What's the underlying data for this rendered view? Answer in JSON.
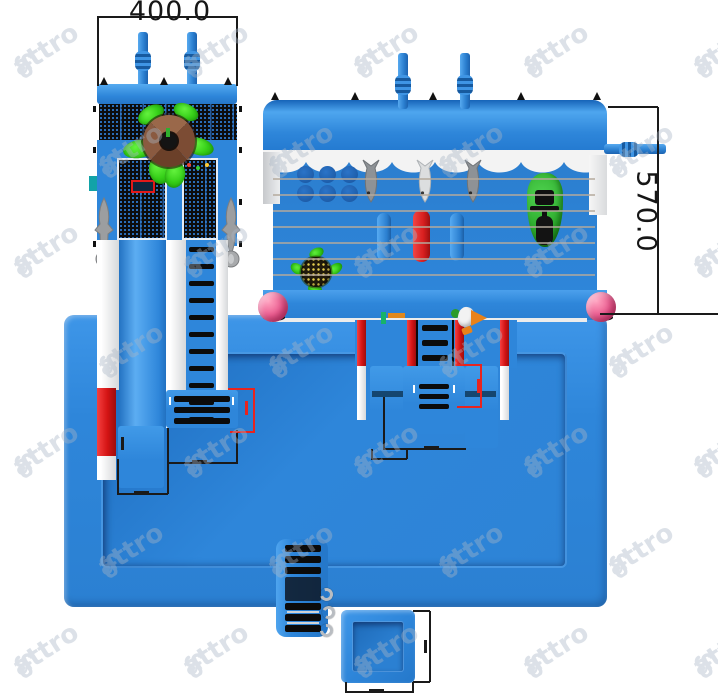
{
  "drawing": {
    "width_dimension": "400.0",
    "height_dimension": "570.0"
  },
  "watermark": {
    "text": "attro"
  },
  "icons": {
    "tree_top": "tree-top-view",
    "shark": "shark-figure",
    "fish": "hanging-fish",
    "turtle": "turtle-float",
    "jetski": "jet-ski-float",
    "parrot": "parrot-ornament"
  },
  "colors": {
    "blue": "#2e86da",
    "blue_dark": "#1d64b4",
    "blue_light": "#55aaf0",
    "red": "#df1d18",
    "pink": "#ec5f92",
    "leaf_green": "#35cf18",
    "boat_green": "#2fae2f",
    "trunk_brown": "#8a5a40",
    "shark_gray": "#9c9ea0",
    "rail_white": "#f2f3f4",
    "string_tan": "#b4a99c",
    "line_black": "#1a1a1a",
    "line_red": "#e8241f"
  }
}
